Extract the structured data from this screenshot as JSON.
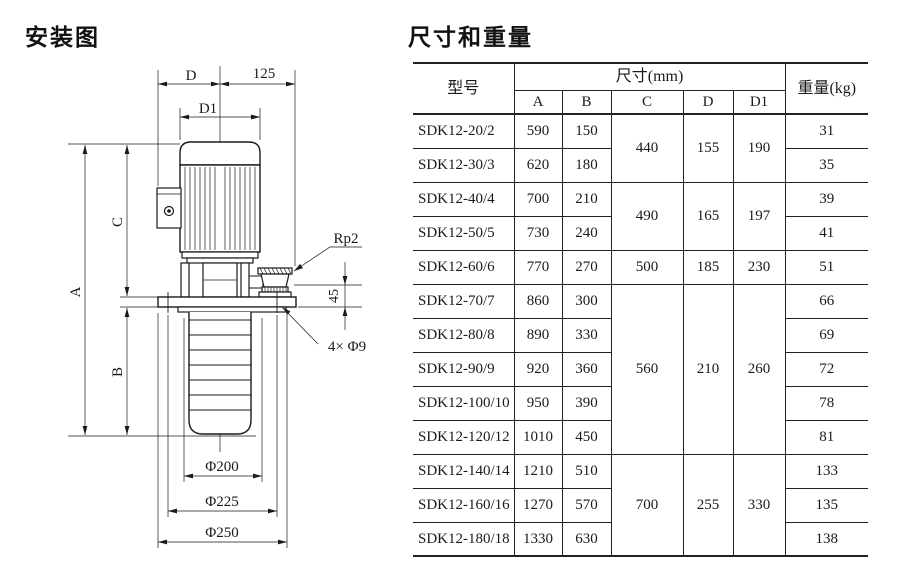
{
  "page": {
    "diagram_title": "安装图",
    "table_title": "尺寸和重量"
  },
  "diagram": {
    "labels": {
      "dim_d": "D",
      "dim_125": "125",
      "dim_d1": "D1",
      "dim_a": "A",
      "dim_c": "C",
      "dim_b": "B",
      "port_thread": "Rp2",
      "dim_45": "45",
      "flange_holes": "4× Φ9",
      "phi_200": "Φ200",
      "phi_225": "Φ225",
      "phi_250": "Φ250"
    }
  },
  "table": {
    "header": {
      "model": "型号",
      "size_group": "尺寸(mm)",
      "weight": "重量(kg)",
      "cols": [
        "A",
        "B",
        "C",
        "D",
        "D1"
      ]
    },
    "rows": [
      {
        "model": "SDK12-20/2",
        "a": "590",
        "b": "150",
        "c": "440",
        "d": "155",
        "d1": "190",
        "w": "31"
      },
      {
        "model": "SDK12-30/3",
        "a": "620",
        "b": "180",
        "w": "35"
      },
      {
        "model": "SDK12-40/4",
        "a": "700",
        "b": "210",
        "c": "490",
        "d": "165",
        "d1": "197",
        "w": "39"
      },
      {
        "model": "SDK12-50/5",
        "a": "730",
        "b": "240",
        "w": "41"
      },
      {
        "model": "SDK12-60/6",
        "a": "770",
        "b": "270",
        "c": "500",
        "d": "185",
        "d1": "230",
        "w": "51"
      },
      {
        "model": "SDK12-70/7",
        "a": "860",
        "b": "300",
        "c": "560",
        "d": "210",
        "d1": "260",
        "w": "66"
      },
      {
        "model": "SDK12-80/8",
        "a": "890",
        "b": "330",
        "w": "69"
      },
      {
        "model": "SDK12-90/9",
        "a": "920",
        "b": "360",
        "w": "72"
      },
      {
        "model": "SDK12-100/10",
        "a": "950",
        "b": "390",
        "w": "78"
      },
      {
        "model": "SDK12-120/12",
        "a": "1010",
        "b": "450",
        "w": "81"
      },
      {
        "model": "SDK12-140/14",
        "a": "1210",
        "b": "510",
        "c": "700",
        "d": "255",
        "d1": "330",
        "w": "133"
      },
      {
        "model": "SDK12-160/16",
        "a": "1270",
        "b": "570",
        "w": "135"
      },
      {
        "model": "SDK12-180/18",
        "a": "1330",
        "b": "630",
        "w": "138"
      }
    ]
  }
}
